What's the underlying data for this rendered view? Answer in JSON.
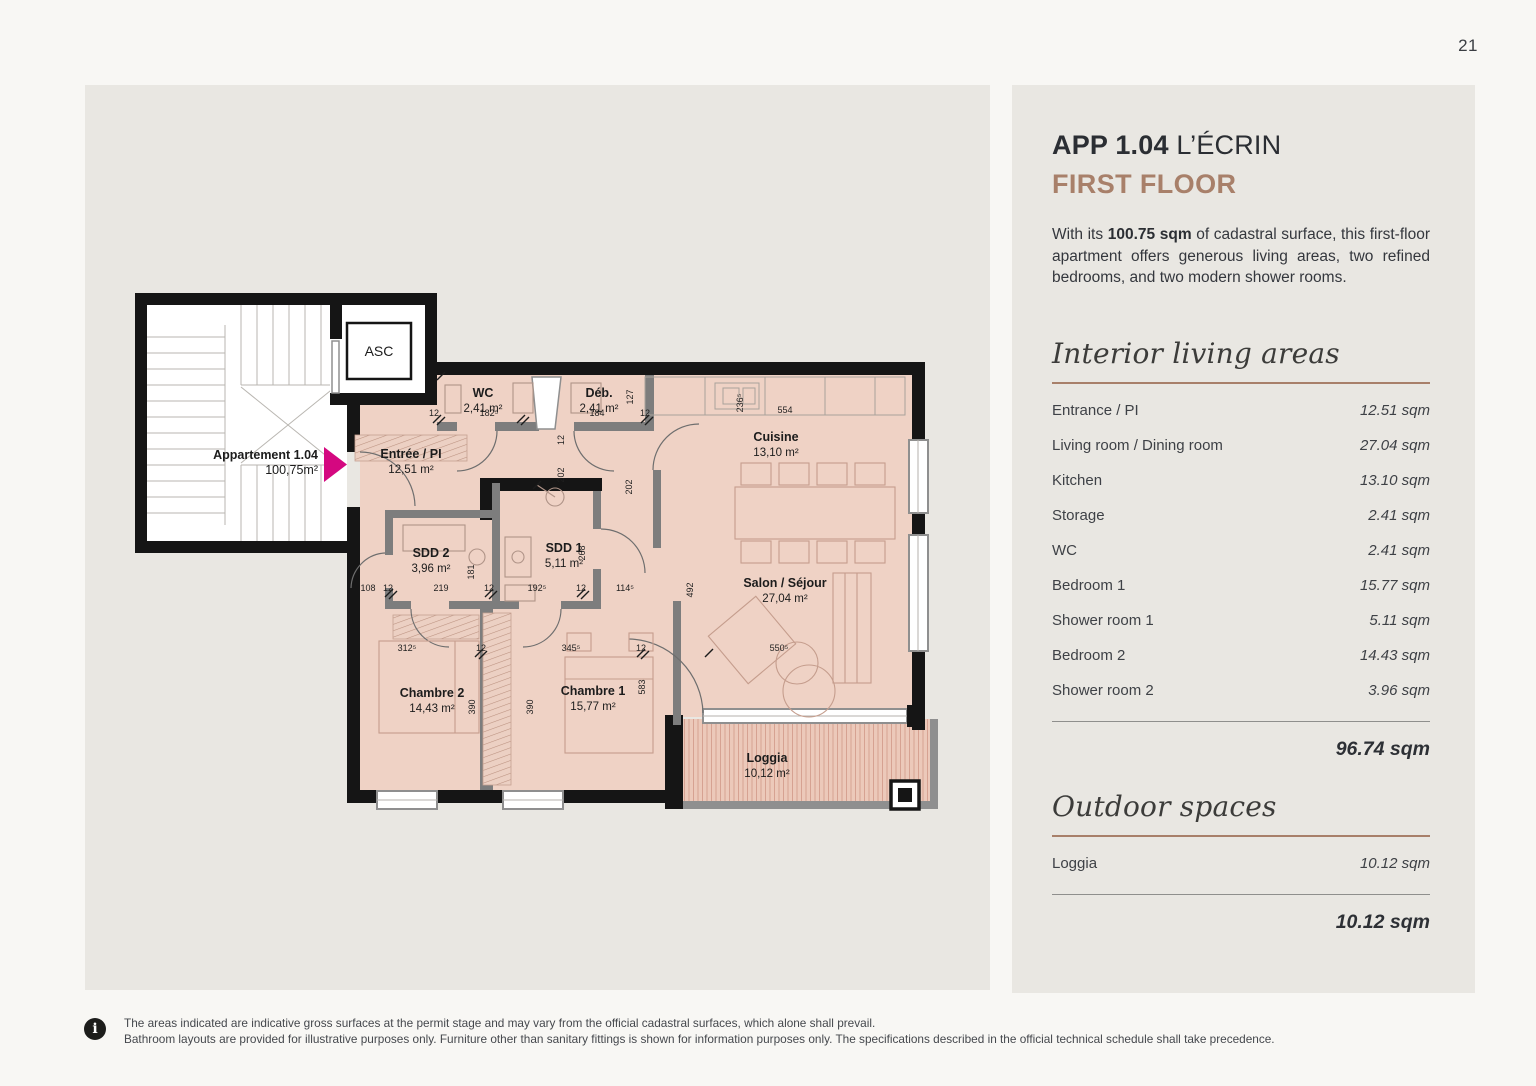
{
  "page": {
    "number": "21"
  },
  "plan": {
    "asc_label": "ASC",
    "apartment_label": {
      "line1": "Appartement 1.04",
      "line2": "100,75m²"
    },
    "rooms": [
      {
        "name": "WC",
        "area": "2,41 m²"
      },
      {
        "name": "Déb.",
        "area": "2,41 m²"
      },
      {
        "name": "Cuisine",
        "area": "13,10 m²"
      },
      {
        "name": "Entrée / PI",
        "area": "12,51 m²"
      },
      {
        "name": "SDD 2",
        "area": "3,96 m²"
      },
      {
        "name": "SDD 1",
        "area": "5,11 m²"
      },
      {
        "name": "Salon / Séjour",
        "area": "27,04 m²"
      },
      {
        "name": "Chambre 2",
        "area": "14,43 m²"
      },
      {
        "name": "Chambre 1",
        "area": "15,77 m²"
      },
      {
        "name": "Loggia",
        "area": "10,12 m²"
      }
    ],
    "dims": [
      "12",
      "182⁵",
      "184",
      "12",
      "554",
      "127",
      "236⁵",
      "202",
      "202",
      "108",
      "12",
      "219",
      "12",
      "192⁵",
      "12",
      "114⁵",
      "181",
      "268",
      "492",
      "312⁵",
      "12",
      "345⁵",
      "12",
      "550⁵",
      "583",
      "390",
      "390",
      "12"
    ]
  },
  "details": {
    "title_bold": "APP 1.04",
    "title_rest": " L’ÉCRIN",
    "subtitle": "FIRST FLOOR",
    "desc_pre": "With its ",
    "desc_bold": "100.75 sqm",
    "desc_post": " of cadastral surface, this first-floor apartment offers generous living areas, two refined bedrooms, and two modern shower rooms.",
    "interior": {
      "heading": "Interior living areas",
      "rows": [
        {
          "label": "Entrance / PI",
          "value": "12.51 sqm"
        },
        {
          "label": "Living room / Dining room",
          "value": "27.04 sqm"
        },
        {
          "label": "Kitchen",
          "value": "13.10 sqm"
        },
        {
          "label": "Storage",
          "value": "2.41 sqm"
        },
        {
          "label": "WC",
          "value": "2.41 sqm"
        },
        {
          "label": "Bedroom 1",
          "value": "15.77 sqm"
        },
        {
          "label": "Shower room 1",
          "value": "5.11 sqm"
        },
        {
          "label": "Bedroom 2",
          "value": "14.43 sqm"
        },
        {
          "label": "Shower room 2",
          "value": "3.96 sqm"
        }
      ],
      "total": "96.74 sqm"
    },
    "outdoor": {
      "heading": "Outdoor spaces",
      "rows": [
        {
          "label": "Loggia",
          "value": "10.12 sqm"
        }
      ],
      "total": "10.12 sqm"
    }
  },
  "footer": {
    "line1": "The areas indicated are indicative gross surfaces at the permit stage and may vary from the official cadastral surfaces, which alone shall prevail.",
    "line2": "Bathroom layouts are provided for illustrative purposes only. Furniture other than sanitary fittings is shown for information purposes only. The specifications described in the official technical schedule shall take precedence."
  },
  "colors": {
    "accent_brown": "#a8806a",
    "magenta": "#d40880",
    "plan_fill": "#efd2c5",
    "wall": "#151515"
  }
}
